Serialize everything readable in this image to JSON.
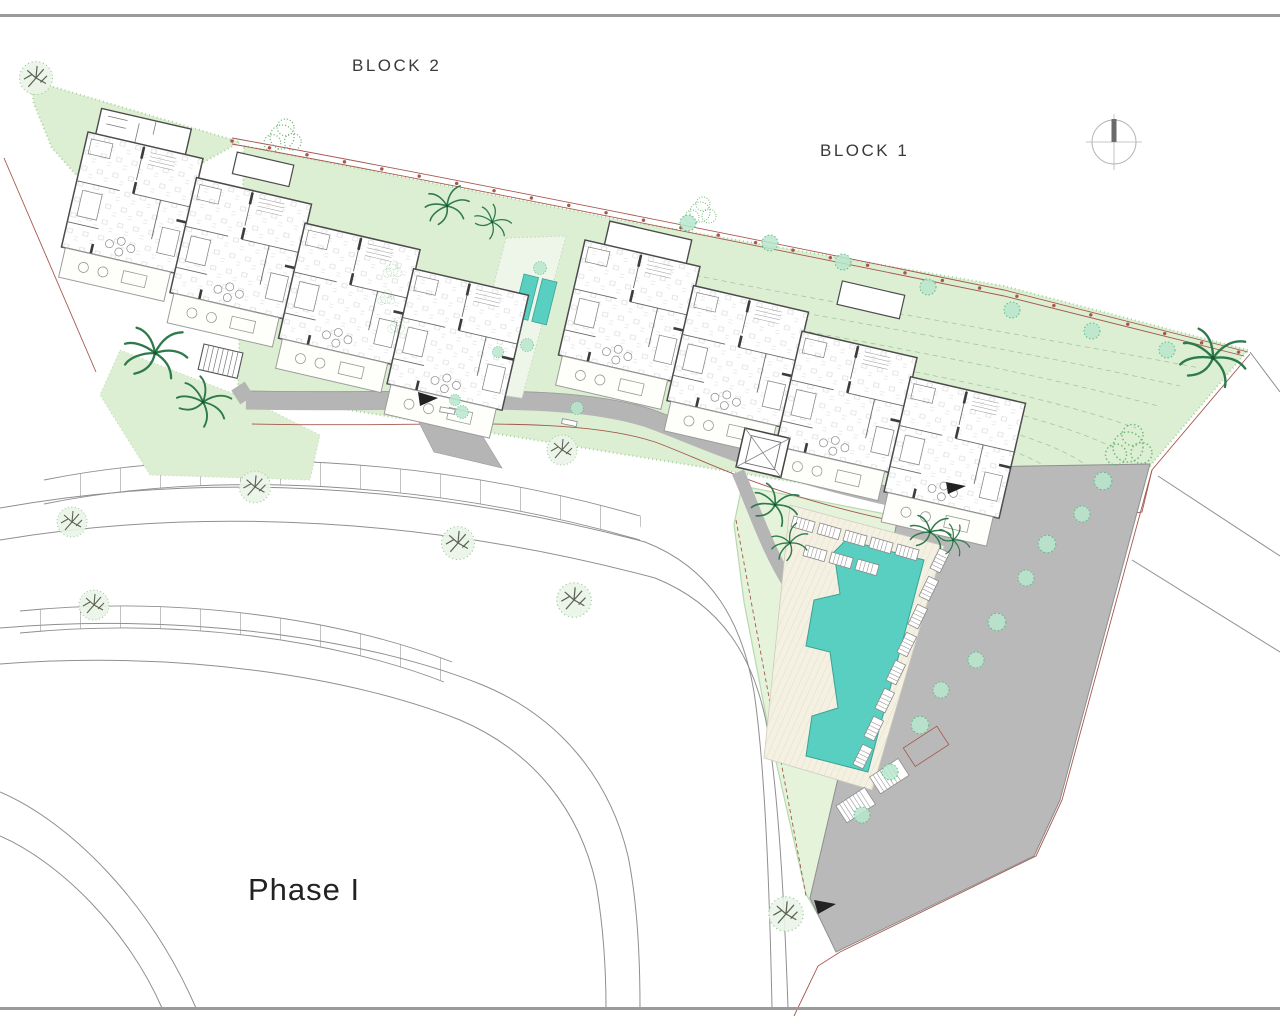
{
  "plan": {
    "labels": {
      "block2": "BLOCK 2",
      "block1": "BLOCK 1",
      "phase": "Phase I"
    },
    "colors": {
      "page_border": "#9b9b9b",
      "lawn": "#dcefd2",
      "lawn_light": "#e5f3db",
      "pool": "#58cfc0",
      "plunge_pool": "#58cfc0",
      "paving": "#b9b9b9",
      "driveway": "#b5b5b5",
      "boundary": "#a5584e",
      "building_wall": "#454545",
      "road_line": "#8f8f8f",
      "contour": "#a3c6a0",
      "tree_fill": "#b9e6cc",
      "tree_edge": "#62b98c",
      "palm": "#2f7a4c",
      "deck": "#f4f1e3",
      "label_text": "#323232"
    },
    "compass": {
      "type": "north-arrow"
    },
    "features": {
      "buildings": [
        "BLOCK 2",
        "BLOCK 1"
      ],
      "amenities": [
        "swimming-pool",
        "pool-deck-sun-loungers",
        "courtyard-plunge-pools",
        "driveway",
        "parking-bays",
        "access-roads",
        "landscaped-gardens",
        "palm-trees",
        "street-trees"
      ]
    }
  }
}
